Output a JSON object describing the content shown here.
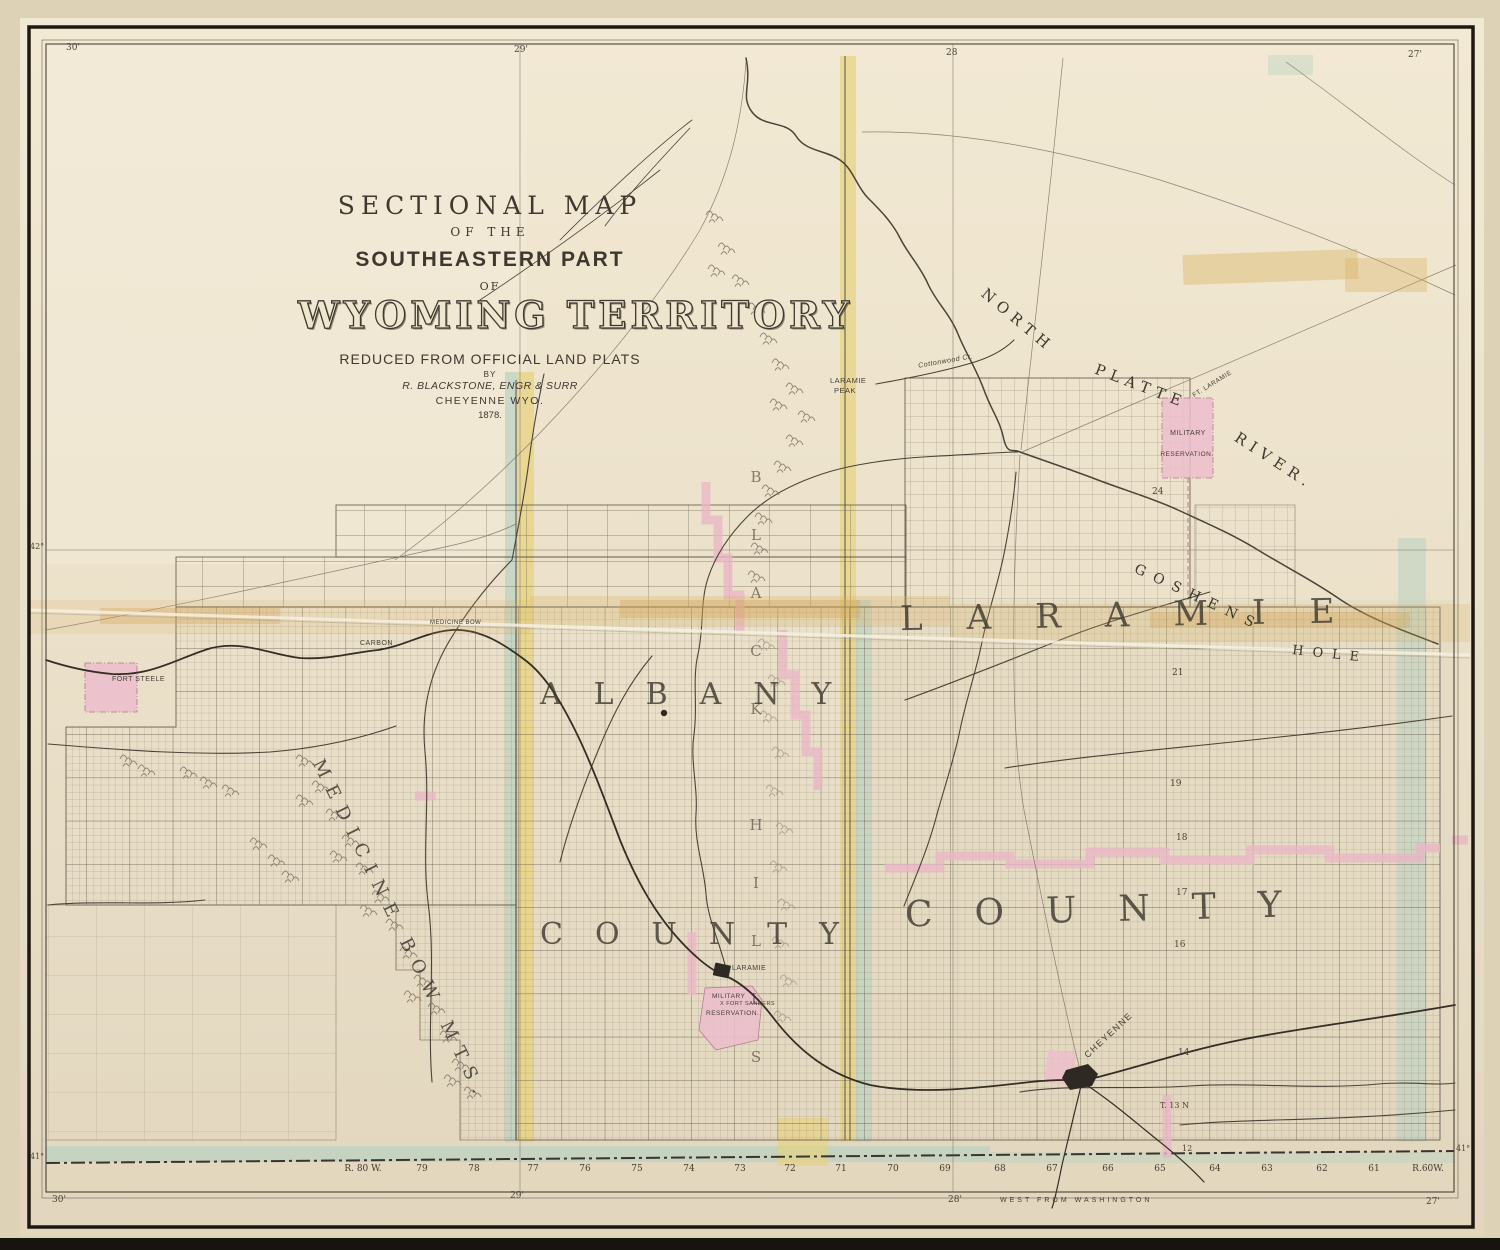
{
  "title_block": {
    "line1": "SECTIONAL MAP",
    "line2": "OF THE",
    "line3": "SOUTHEASTERN PART",
    "line4": "OF",
    "line5": "WYOMING TERRITORY",
    "line6": "REDUCED FROM OFFICIAL LAND PLATS",
    "line7": "BY",
    "line8": "R. BLACKSTONE, ENGR & SURR",
    "line9": "CHEYENNE WYO.",
    "line10": "1878."
  },
  "counties": {
    "laramie": "LARAMIE",
    "laramie_county_word": "COUNTY",
    "albany": "ALBANY",
    "albany_county_word": "COUNTY"
  },
  "physical": {
    "north": "NORTH",
    "platte": "PLATTE",
    "river": "RIVER.",
    "laramie_peak_1": "LARAMIE",
    "laramie_peak_2": "PEAK",
    "goshens": "GOSHENS",
    "hole": "HOLE",
    "medicine_bow_mts": "MEDICINE BOW MTS.",
    "black_hills": "BLACK HILLS",
    "cottonwood_cr": "Cottonwood Cr."
  },
  "places": {
    "fort_steele": "FORT STEELE",
    "carbon": "CARBON",
    "medicine_bow": "MEDICINE BOW",
    "laramie_city": "LARAMIE",
    "cheyenne": "CHEYENNE",
    "fort_laramie": "FT. LARAMIE"
  },
  "reservations": {
    "laramie_res_1": "MILITARY",
    "laramie_res_2": "RESERVATION.",
    "sanders_res_1": "MILITARY",
    "sanders_res_2": "X FORT SANDERS",
    "sanders_res_3": "RESERVATION."
  },
  "frame": {
    "top_ticks": [
      "30'",
      "29'",
      "28",
      "27'"
    ],
    "bottom_ticks": [
      "30'",
      "29'",
      "28'",
      "27'"
    ],
    "west_from_washington": "WEST FROM WASHINGTON",
    "lat_42_left": "42°",
    "lat_41_left": "41°",
    "lat_41_right": "41°"
  },
  "ranges": [
    "R. 80 W.",
    "79",
    "78",
    "77",
    "76",
    "75",
    "74",
    "73",
    "72",
    "71",
    "70",
    "69",
    "68",
    "67",
    "66",
    "65",
    "64",
    "63",
    "62",
    "61",
    "R.60W."
  ],
  "townships": {
    "t24": "24",
    "t21": "21",
    "t19": "19",
    "t18": "18",
    "t17": "17",
    "t16": "16",
    "t14": "14",
    "t13n": "T. 13 N",
    "t12": "12"
  },
  "colors": {
    "paper": "#eae0c9",
    "ink": "#4a4236",
    "reservation_pink": "#edbecd",
    "band_yellow": "#e7d37e",
    "band_teal": "#b9d2c2",
    "photo_background": "#17140f"
  }
}
